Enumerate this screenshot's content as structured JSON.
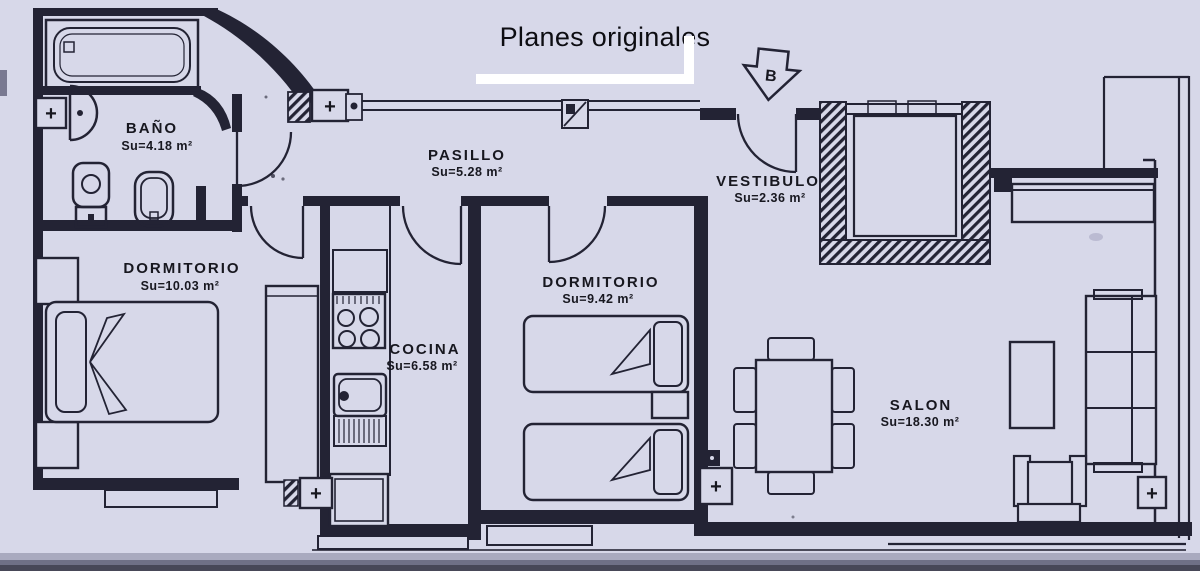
{
  "title": "Planes originales",
  "entrance": {
    "marker": "B"
  },
  "symbols": {
    "radiator": "+"
  },
  "rooms": {
    "bano": {
      "name": "BAÑO",
      "area": "Su=4.18 m²"
    },
    "pasillo": {
      "name": "PASILLO",
      "area": "Su=5.28 m²"
    },
    "vestibulo": {
      "name": "VESTIBULO",
      "area": "Su=2.36 m²"
    },
    "dormitorio1": {
      "name": "DORMITORIO",
      "area": "Su=10.03 m²"
    },
    "cocina": {
      "name": "COCINA",
      "area": "Su=6.58 m²"
    },
    "dormitorio2": {
      "name": "DORMITORIO",
      "area": "Su=9.42 m²"
    },
    "salon": {
      "name": "SALON",
      "area": "Su=18.30 m²"
    }
  },
  "colors": {
    "paper": "#d7d8e9",
    "ink": "#232334"
  }
}
